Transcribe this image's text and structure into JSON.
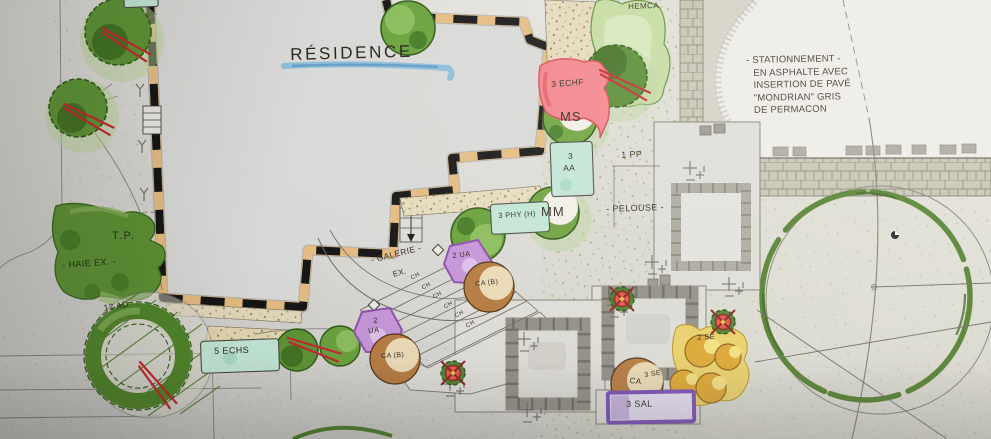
{
  "plan": {
    "residence_title": "RÉSIDENCE",
    "parking_note": [
      "- STATIONNEMENT -",
      "EN ASPHALTE AVEC",
      "INSERTION DE PAVÉ",
      "\"MONDRIAN\" GRIS",
      "DE PERMACON"
    ],
    "area_labels": {
      "pelouse": "- PELOUSE -",
      "galerie": "- GALERIE -",
      "galerie_suffix": "EX.",
      "haie_existante": "- HAIE EX. -",
      "transformer_pad": "T.P."
    },
    "plant_labels": {
      "hemca": "HEMCA",
      "echf": "3 ECHF",
      "ms": "MS",
      "aa_qty": "3",
      "aa": "AA",
      "mm": "MM",
      "phy": "3 PHY (H)",
      "pp": "1 PP",
      "ad": "12 AD",
      "echs": "5 ECHS",
      "ua_upper": "2 UA",
      "ua_lower_qty": "2",
      "ua_lower": "UA",
      "ca_upper": "CA (B)",
      "ca_lower": "CA (B)",
      "ca_right": "CA",
      "se_upper": "2 SE",
      "se_lower": "3 SE",
      "sal": "3 SAL"
    },
    "stairs": {
      "step_label": "CH"
    },
    "colors": {
      "marker_green": "#4f7d2a",
      "light_green": "#a8c97e",
      "teal_bed": "#c2e5d4",
      "pink_bed": "#f2838a",
      "purple_bed": "#8c4fa8",
      "brown_plant": "#b5793f",
      "yellow_bed": "#e9cf67",
      "wall_tan": "#e3bb80",
      "marker_red": "#c1272d",
      "underline_blue": "#6aaede"
    }
  }
}
